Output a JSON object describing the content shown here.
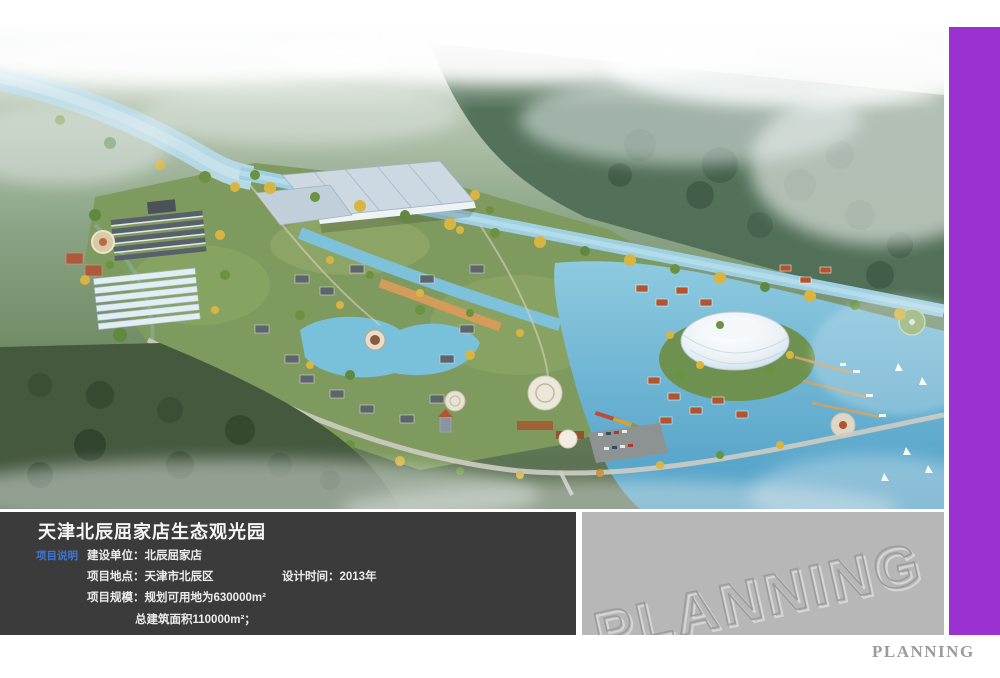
{
  "colors": {
    "accent-purple": "#9b31d1",
    "panel-dark": "#3b3b3b",
    "panel-gray": "#b7b7b7",
    "label-blue": "#4076d4",
    "footer-gray": "#9b9b9b"
  },
  "info_panel": {
    "title": "天津北辰屈家店生态观光园",
    "section_label": "项目说明",
    "construction_unit_label": "建设单位：",
    "construction_unit_value": "北辰屈家店",
    "location_label": "项目地点：",
    "location_value": "天津市北辰区",
    "design_time_label": "设计时间：",
    "design_time_value": "2013年",
    "scale_label": "项目规模：",
    "scale_value_line1": "规划可用地为630000m²",
    "scale_value_line2": "总建筑面积110000m²；"
  },
  "watermark_panel": {
    "text": "PLANNING"
  },
  "footer": {
    "brand": "PLANNING"
  }
}
